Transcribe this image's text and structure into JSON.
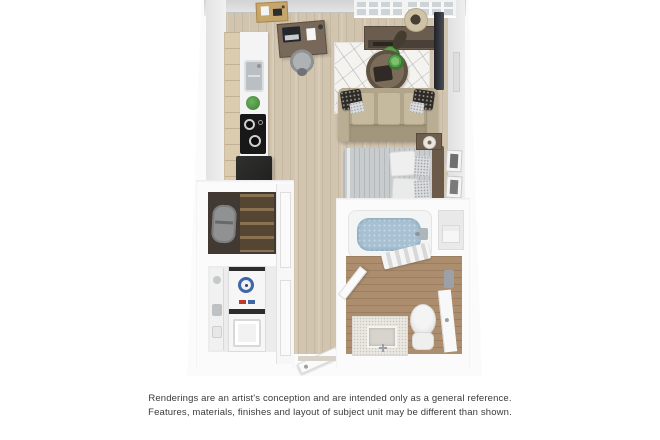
{
  "page": {
    "width": 660,
    "height": 440,
    "background": "#ffffff",
    "content": "3D top-down rendering of a studio apartment floor plan"
  },
  "disclaimer": {
    "line1": "Renderings are an artist's conception and are intended only as a general reference.",
    "line2": "Features, materials, finishes and layout of subject unit may be different than shown.",
    "text_color": "#3a3a3a"
  },
  "floorplan": {
    "kind": "3d-floor-plan-rendering",
    "rooms": [
      "living-sleeping area",
      "kitchen",
      "closet",
      "laundry",
      "entry hallway",
      "bathroom"
    ],
    "objects": [
      "corkboard",
      "desk",
      "laptop",
      "desk-chair",
      "window",
      "kitchen-cabinets",
      "kitchen-counter",
      "sink",
      "plant",
      "cooktop",
      "refrigerator",
      "media-console",
      "console-plant",
      "floor-lamp",
      "wall-tv",
      "area-rug",
      "coffee-table",
      "sofa",
      "throw-pillows",
      "bed",
      "headboard",
      "nightstand",
      "table-lamp",
      "wall-art",
      "closet-shelves",
      "duffel-bag",
      "stacked-washer-dryer",
      "closet-doors",
      "entry-door",
      "bathtub",
      "tub-faucet",
      "towel-shelf",
      "bath-towels",
      "bathroom-door",
      "vanity",
      "vanity-sink",
      "toilet",
      "right-door",
      "towel-bar"
    ],
    "colors": {
      "wall": "#fbfbfb",
      "wall_face": "#e2e2e2",
      "floor_wood": "#d2c5af",
      "floor_bath": "#ac8d6e",
      "rug": "#f4f3f0",
      "sofa": "#b1a58b",
      "cushion": "#c5b99e",
      "bed_duvet": "#c9cccd",
      "tub_water": "#a7c1d3",
      "appliance_dark": "#1f1f1f",
      "cabinet_wood": "#dbcbaf",
      "desk_wood": "#77685a",
      "plant_green": "#57a04b",
      "dial_blue": "#3e66a8"
    }
  }
}
